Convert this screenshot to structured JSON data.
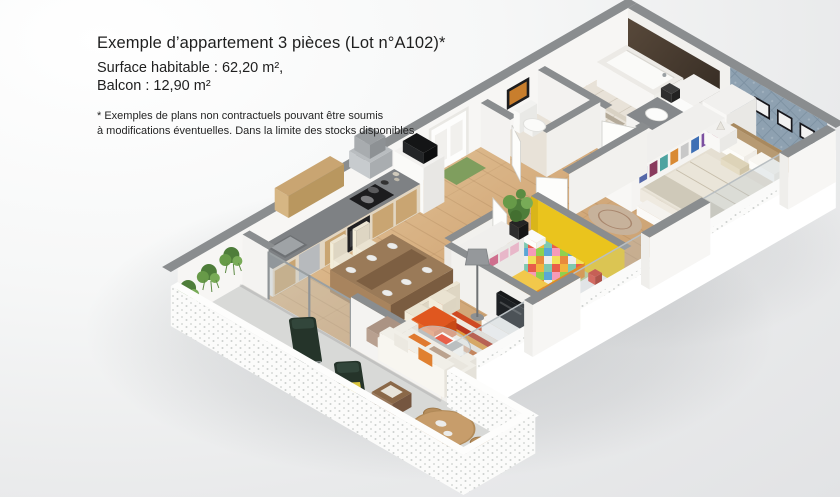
{
  "info": {
    "title": "Exemple d’appartement 3 pièces (Lot n°A102)*",
    "line_surface": "Surface habitable : 62,20 m²,",
    "line_balcony": "Balcon : 12,90 m²",
    "footnote_line1": "* Exemples de plans non contractuels pouvant être soumis",
    "footnote_line2": "à modifications éventuelles. Dans la limite des stocks disponibles"
  },
  "colors": {
    "background_top": "#ffffff",
    "background_bottom": "#e2e3e5",
    "wall_cap_gray": "#8a8d8f",
    "wall_white": "#f4f3f1",
    "floor_wood": "#d7b488",
    "bathroom_tile": "#e8e2d8",
    "dark_bath_panel": "#43382d",
    "bedroom_feature_wall": "#8ea1b1",
    "kids_wall_yellow": "#eac41d",
    "kids_floor_green": "#b7cb8f",
    "counter_gray": "#7e8184",
    "cabinet_wood": "#c9a572",
    "sofa_cream": "#efede6",
    "accent_orange": "#e0571f",
    "rug_red": "#cf4a22",
    "lounger_green": "#25342a",
    "balcony_floor": "#d8d9d7",
    "table_wood": "#8c6c4c",
    "doormat_green": "#7f9e5e",
    "plant_green": "#57893f",
    "tv_black": "#17191b",
    "linen_beige": "#eae5d9"
  }
}
